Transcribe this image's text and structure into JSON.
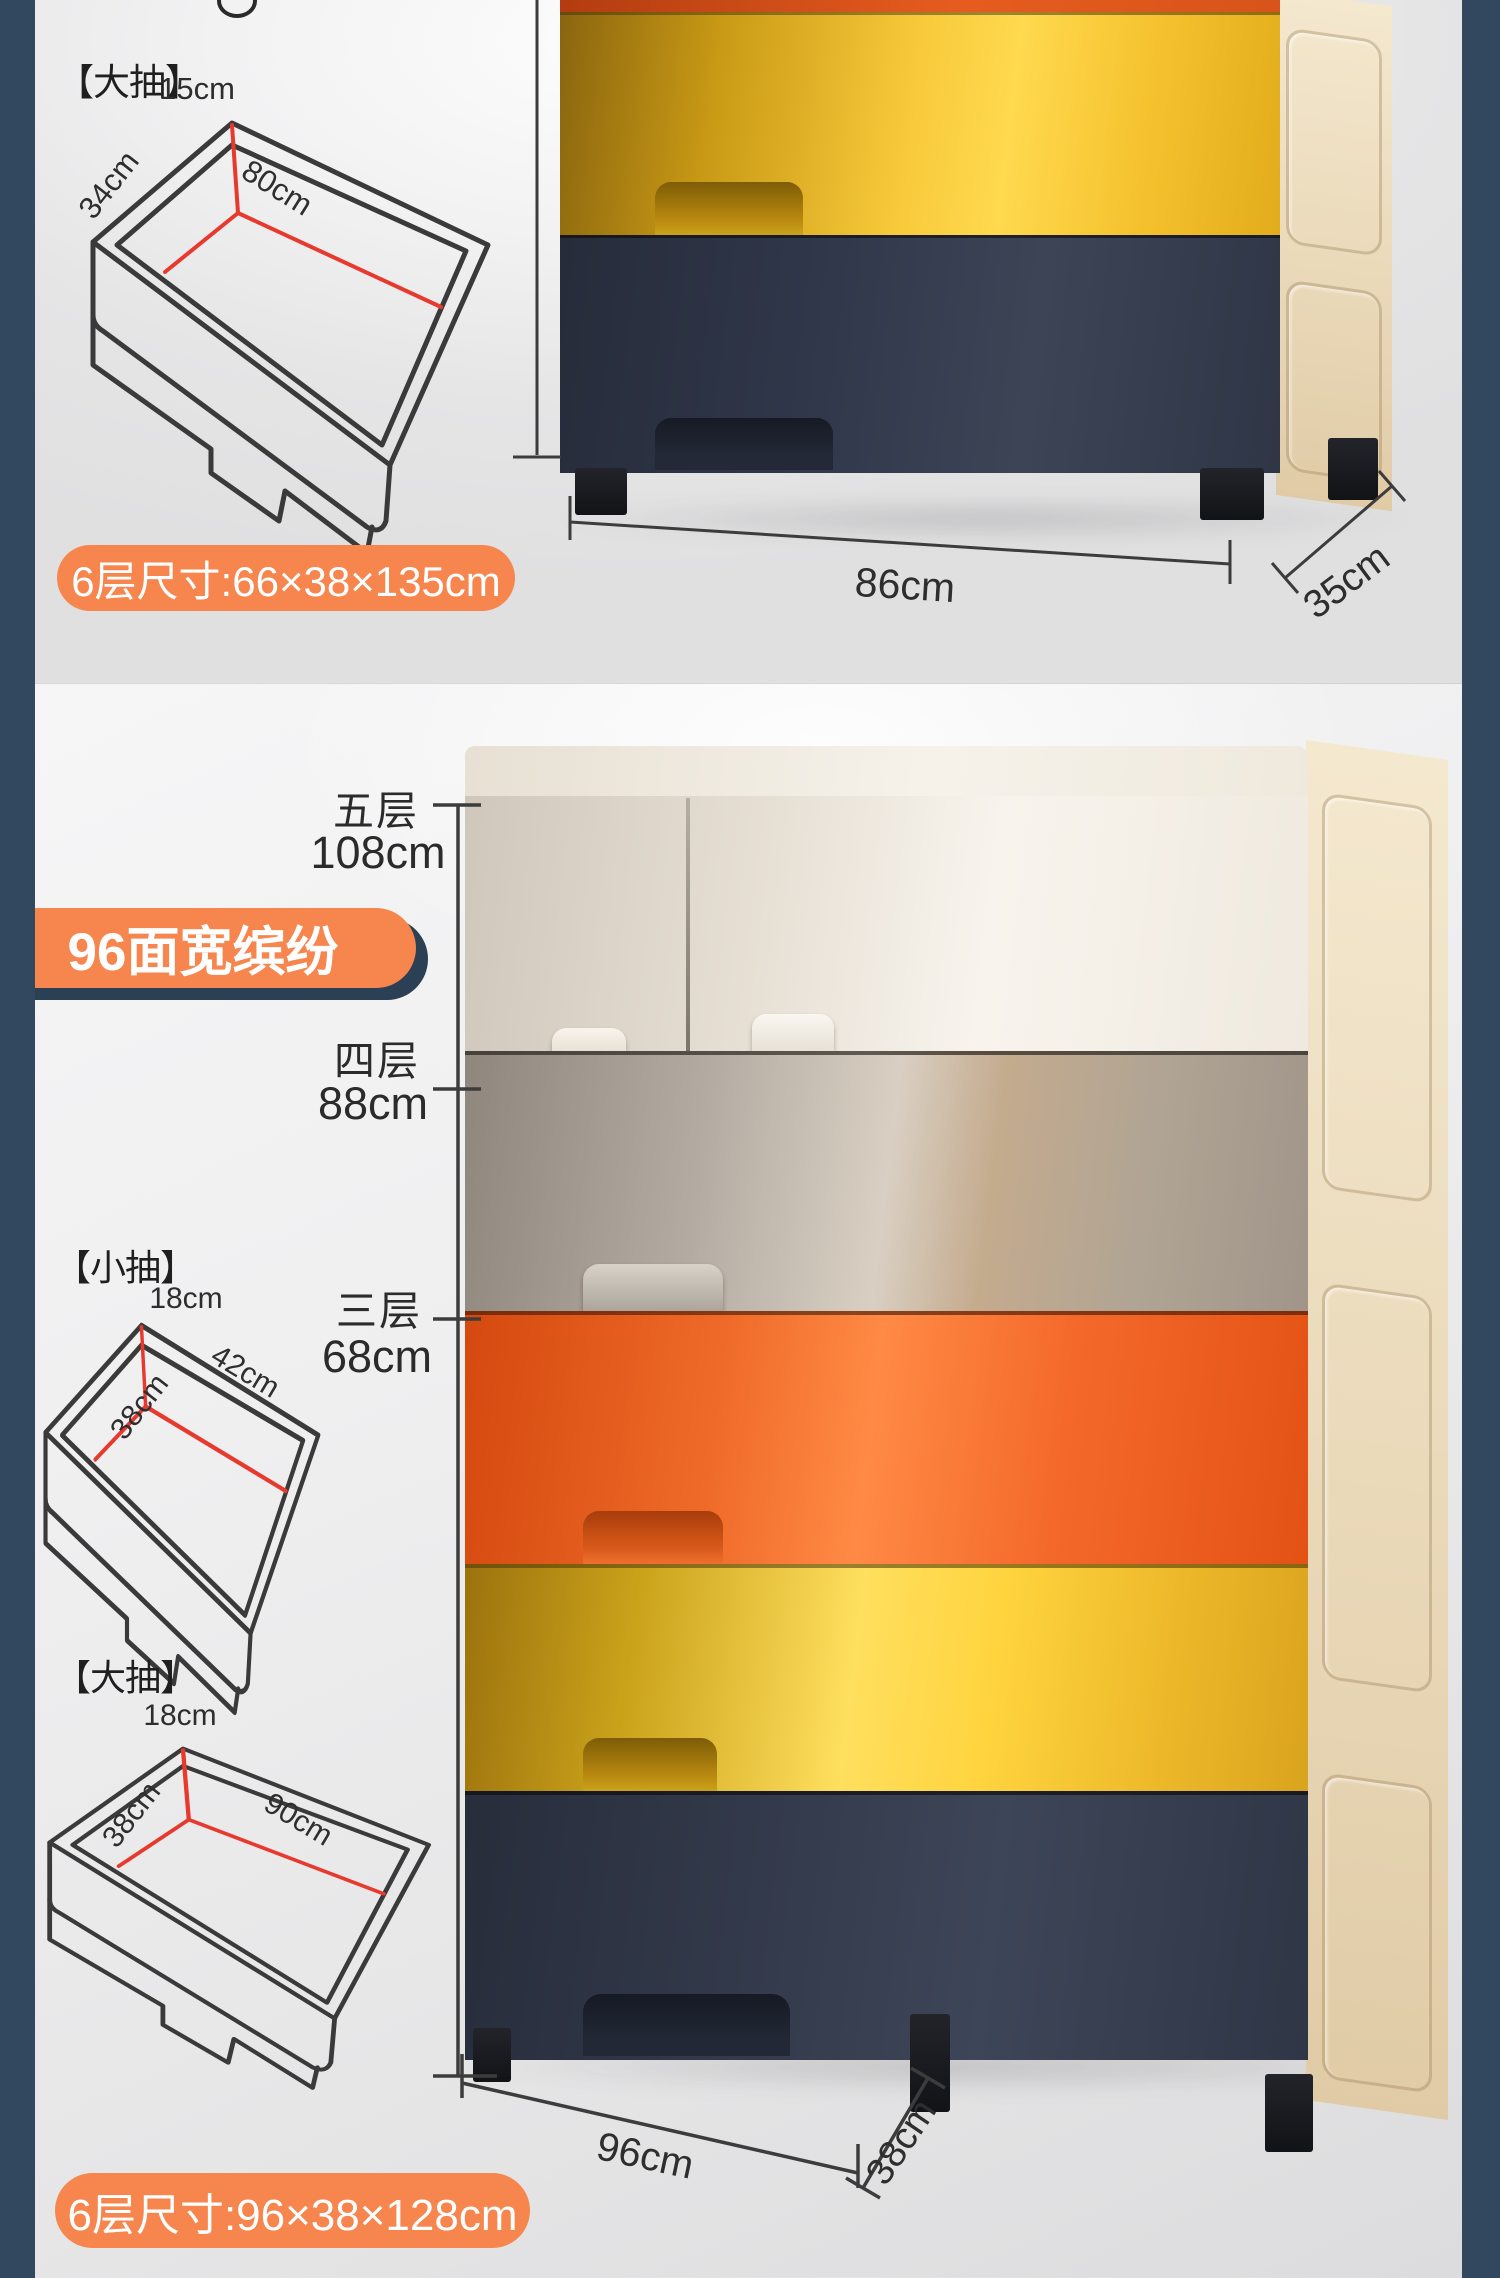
{
  "page": {
    "background_color": "#32485e",
    "accent_orange": "#f6854e",
    "dimension_line_red": "#e8392f",
    "cabinet_navy": "#333a4b",
    "cabinet_yellow": "#ffd94e",
    "cabinet_orange": "#ee5f1e"
  },
  "top_section": {
    "large_drawer": {
      "label": "【大抽】",
      "height": "15cm",
      "depth": "34cm",
      "width": "80cm"
    },
    "size_badge": "6层尺寸:66×38×135cm",
    "cabinet_width": "86cm",
    "cabinet_depth": "35cm"
  },
  "bottom_section": {
    "feature_badge": "96面宽缤纷",
    "tiers": [
      {
        "name": "五层",
        "height": "108cm"
      },
      {
        "name": "四层",
        "height": "88cm"
      },
      {
        "name": "三层",
        "height": "68cm"
      }
    ],
    "small_drawer": {
      "label": "【小抽】",
      "height": "18cm",
      "width": "42cm",
      "depth": "38cm"
    },
    "large_drawer": {
      "label": "【大抽】",
      "height": "18cm",
      "width": "90cm",
      "depth": "38cm"
    },
    "cabinet_width": "96cm",
    "cabinet_depth": "38cm",
    "size_badge": "6层尺寸:96×38×128cm"
  }
}
